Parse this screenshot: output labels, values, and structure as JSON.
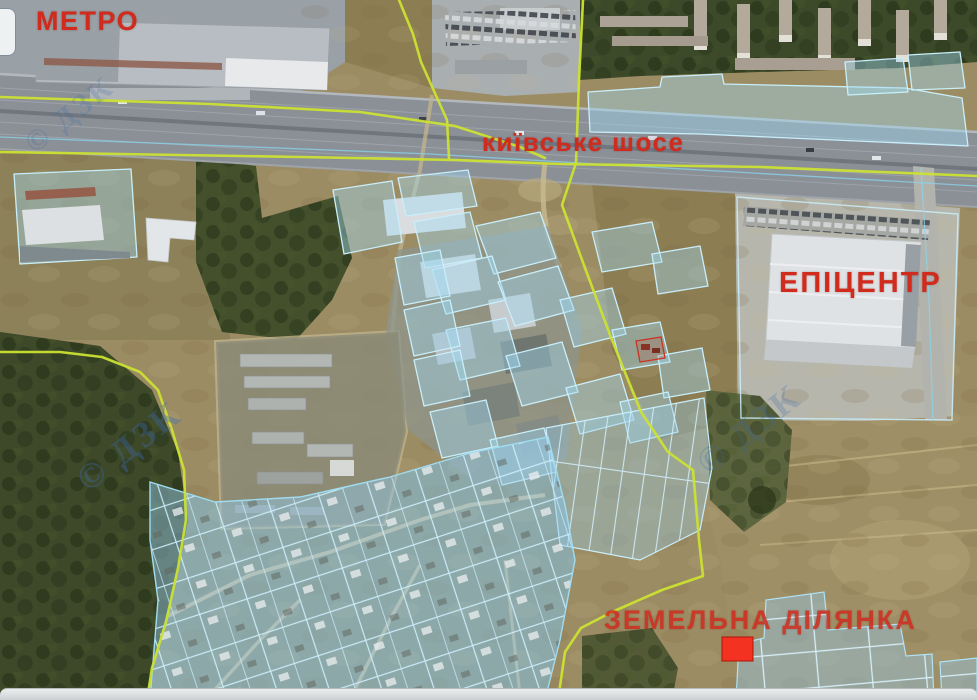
{
  "map": {
    "labels": {
      "metro": "МЕТРО",
      "highway": "київське шосе",
      "epicentr": "ЕПІЦЕНТР",
      "land_plot": "ЗЕМЕЛЬНА ДІЛЯНКА"
    },
    "watermark_text": "© ДЗК",
    "colors": {
      "label_red": "#d02b1d",
      "cadastral_yellow": "#cbe231",
      "parcel_blue": "#9fd8f0",
      "parcel_stroke": "#c9eefb",
      "plot_marker": "#f43222"
    }
  }
}
